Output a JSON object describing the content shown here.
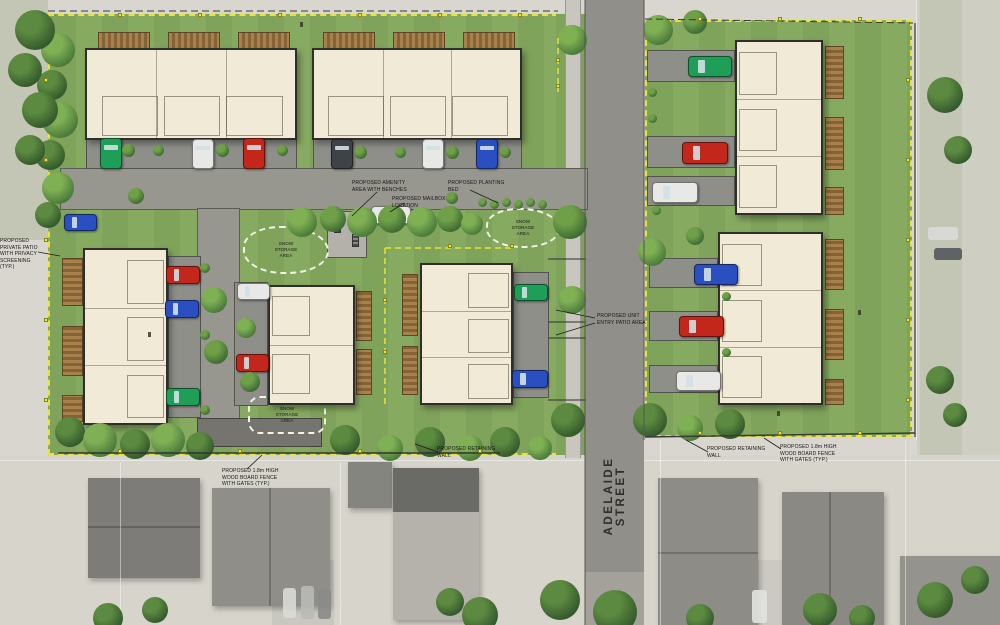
{
  "street": {
    "name": "ADELAIDE STREET"
  },
  "annotations": {
    "private_patio": "PROPOSED PRIVATE PATIO\nWITH PRIVACY\nSCREENING (TYP.)",
    "amenity": "PROPOSED AMENITY\nAREA WITH BENCHES",
    "mailbox": "PROPOSED MAILBOX\nLOCATION",
    "planting_bed": "PROPOSED PLANTING\nBED",
    "snow_storage": "SNOW\nSTORAGE\nAREA",
    "unit_patio": "PROPOSED UNIT\nENTRY PATIO AREA",
    "retaining_wall": "PROPOSED RETAINING\nWALL",
    "fence": "PROPOSED 1.8m HIGH\nWOOD BOARD FENCE\nWITH GATES (TYP.)"
  },
  "colors": {
    "lawn": "#7fa35b",
    "building": "#f1ead7",
    "asphalt": "#908f8a",
    "property_line": "#e9e334",
    "deck_wood": "#9a7a46",
    "car_red": "#c3271b",
    "car_blue": "#2a4fc0",
    "car_green": "#1f9e57",
    "car_white": "#e8e8e6",
    "car_dark": "#3f4246"
  }
}
